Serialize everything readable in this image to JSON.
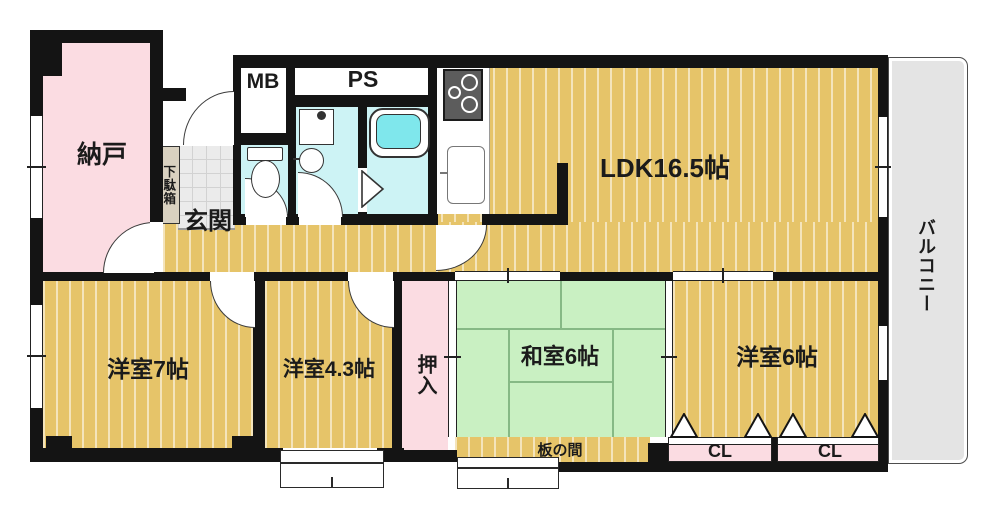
{
  "plan": {
    "nando": "納戸",
    "getabako": "下駄箱",
    "genkan": "玄関",
    "mb": "MB",
    "ps": "PS",
    "ldk": "LDK16.5帖",
    "balcony": "バルコニー",
    "western7": "洋室7帖",
    "western43": "洋室4.3帖",
    "oshiire": "押入",
    "washitsu": "和室6帖",
    "itanoma": "板の間",
    "western6": "洋室6帖",
    "cl1": "CL",
    "cl2": "CL"
  },
  "colors": {
    "wall": "#141414",
    "wood_floor": "#e6c469",
    "tatami": "#c9f0c2",
    "service_pink": "#fbdce2",
    "wet_cyan": "#cdf3f5",
    "balcony_gray": "#e4e4e4",
    "bathtub": "#7fe7ec"
  }
}
